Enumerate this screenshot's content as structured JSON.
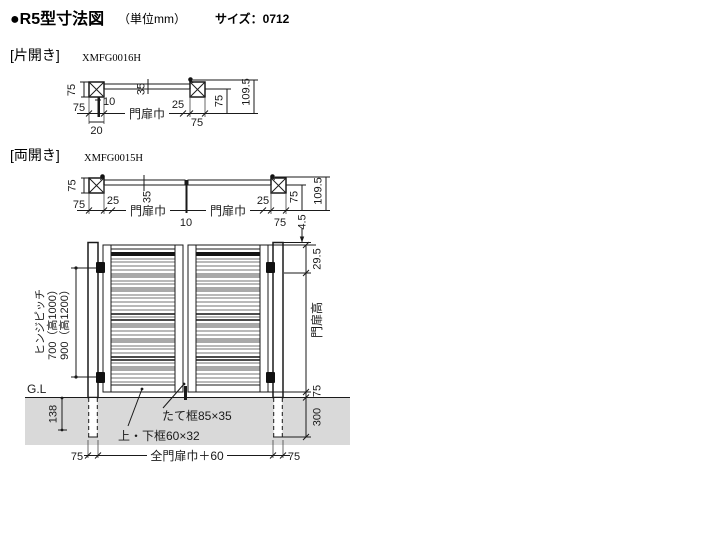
{
  "header": {
    "title": "●R5型寸法図",
    "unit": "（単位mm）",
    "size": "サイズ：0712"
  },
  "single": {
    "label": "[片開き]",
    "code": "XMFG0016H",
    "d_post_h": "75",
    "d_post_w": "75",
    "d20": "20",
    "d10": "10",
    "d35": "35",
    "d_gate_w": "門扉巾",
    "d25": "25",
    "d_post_w_r": "75",
    "d75_r": "75",
    "d_total": "109.5"
  },
  "double": {
    "label": "[両開き]",
    "code": "XMFG0015H",
    "d_post_h": "75",
    "d_post_w": "75",
    "d25_l": "25",
    "d35": "35",
    "d_gate_w_l": "門扉巾",
    "d10": "10",
    "d_gate_w_r": "門扉巾",
    "d25_r": "25",
    "d_post_w_r": "75",
    "d75_r": "75",
    "d_total": "109.5"
  },
  "elevation": {
    "d45": "4.5",
    "d295": "29.5",
    "d_gate_h": "門扉高",
    "d75_gl": "75",
    "d300": "300",
    "hinge_label": "ヒンジピッチ",
    "hinge_700": "700（高1000）",
    "hinge_900": "900（高1200）",
    "gl": "G.L",
    "d138": "138",
    "d75_bl": "75",
    "d_total_w": "全門扉巾＋60",
    "d75_br": "75",
    "callout_stile": "たて框85×35",
    "callout_rail": "上・下框60×32"
  }
}
